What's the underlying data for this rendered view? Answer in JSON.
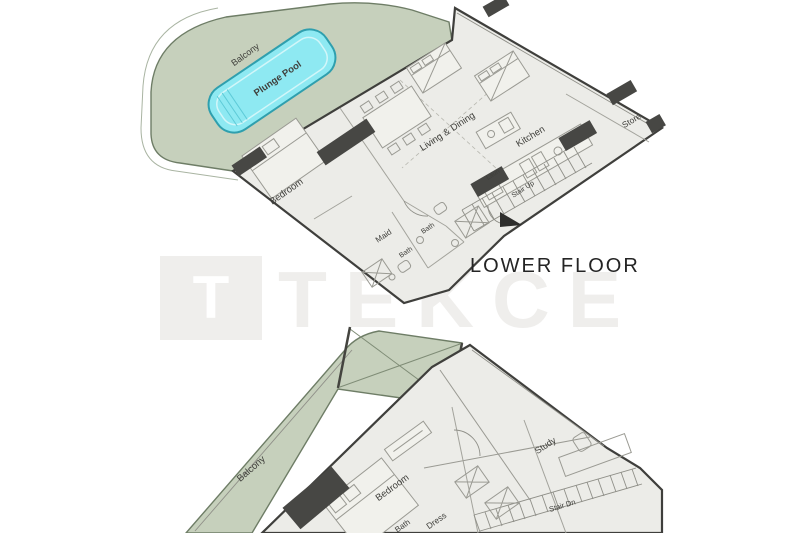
{
  "image_type": "architectural floor plan",
  "upper_plan": {
    "caption": "LOWER FLOOR",
    "labels": {
      "balcony": "Balcony",
      "plunge_pool": "Plunge Pool",
      "living_dining": "Living & Dining",
      "kitchen": "Kitchen",
      "store": "Store",
      "stair_up": "Stair Up",
      "laun": "Laun",
      "bedroom": "Bedroom",
      "maid": "Maid",
      "bath1": "Bath",
      "bath2": "Bath"
    }
  },
  "lower_plan": {
    "labels": {
      "balcony": "Balcony",
      "bedroom": "Bedroom",
      "dress": "Dress",
      "study": "Study",
      "bath": "Bath",
      "stair_dn": "Stair Dn"
    }
  },
  "watermark": {
    "logo_letter": "T",
    "brand": "TEKCE"
  },
  "colors": {
    "balcony_green": "#c6d0bc",
    "balcony_edge": "#6e7d66",
    "pool_cyan": "#8ee9f2",
    "pool_edge": "#2f9fae",
    "floor_fill": "#ecece8",
    "wall_dark": "#3f3f3c",
    "column_dark": "#474744",
    "caption_text": "#242424",
    "watermark_gray": "#a8a193"
  }
}
